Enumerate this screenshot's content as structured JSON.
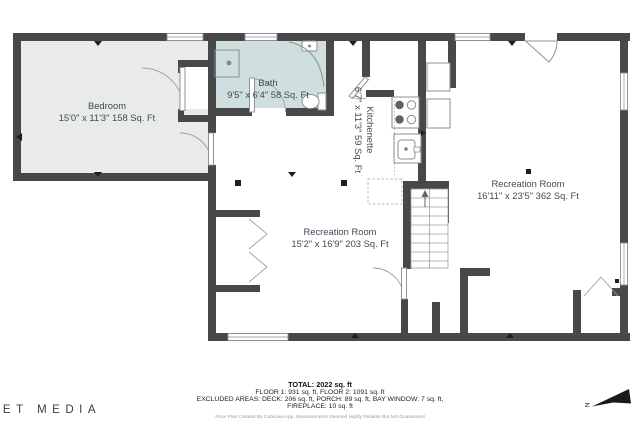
{
  "floor_plan": {
    "rooms": {
      "bedroom": {
        "name": "Bedroom",
        "dims": "15'0\" x 11'3\" 158 Sq. Ft"
      },
      "bath": {
        "name": "Bath",
        "dims": "9'5\" x 6'4\" 58 Sq. Ft"
      },
      "kitchenette": {
        "name": "Kitchenette",
        "dims": "6'7\" x 11'3\" 59 Sq. Ft"
      },
      "rec_large": {
        "name": "Recreation Room",
        "dims": "16'11\" x 23'5\" 362 Sq. Ft"
      },
      "rec_small": {
        "name": "Recreation Room",
        "dims": "15'2\" x 16'9\" 203 Sq. Ft"
      }
    },
    "colors": {
      "wall": "#484848",
      "bedroom_fill": "#e9eaea",
      "bath_fill": "#cfdfdf",
      "label_text": "#3f4b55"
    }
  },
  "summary": {
    "total": "TOTAL: 2022 sq. ft",
    "floors": "FLOOR 1: 931 sq. ft, FLOOR 2: 1091 sq. ft",
    "excluded_line1": "EXCLUDED AREAS: DECK: 206 sq. ft, PORCH: 89 sq. ft, BAY WINDOW: 7 sq. ft,",
    "excluded_line2": "FIREPLACE: 10 sq. ft",
    "disclaimer": "Floor Plan Created By Cubicasa App. Measurements Deemed Highly Reliable But Not Guaranteed"
  },
  "branding": {
    "logo": "NAUSET MEDIA"
  },
  "compass": {
    "label": "N"
  }
}
